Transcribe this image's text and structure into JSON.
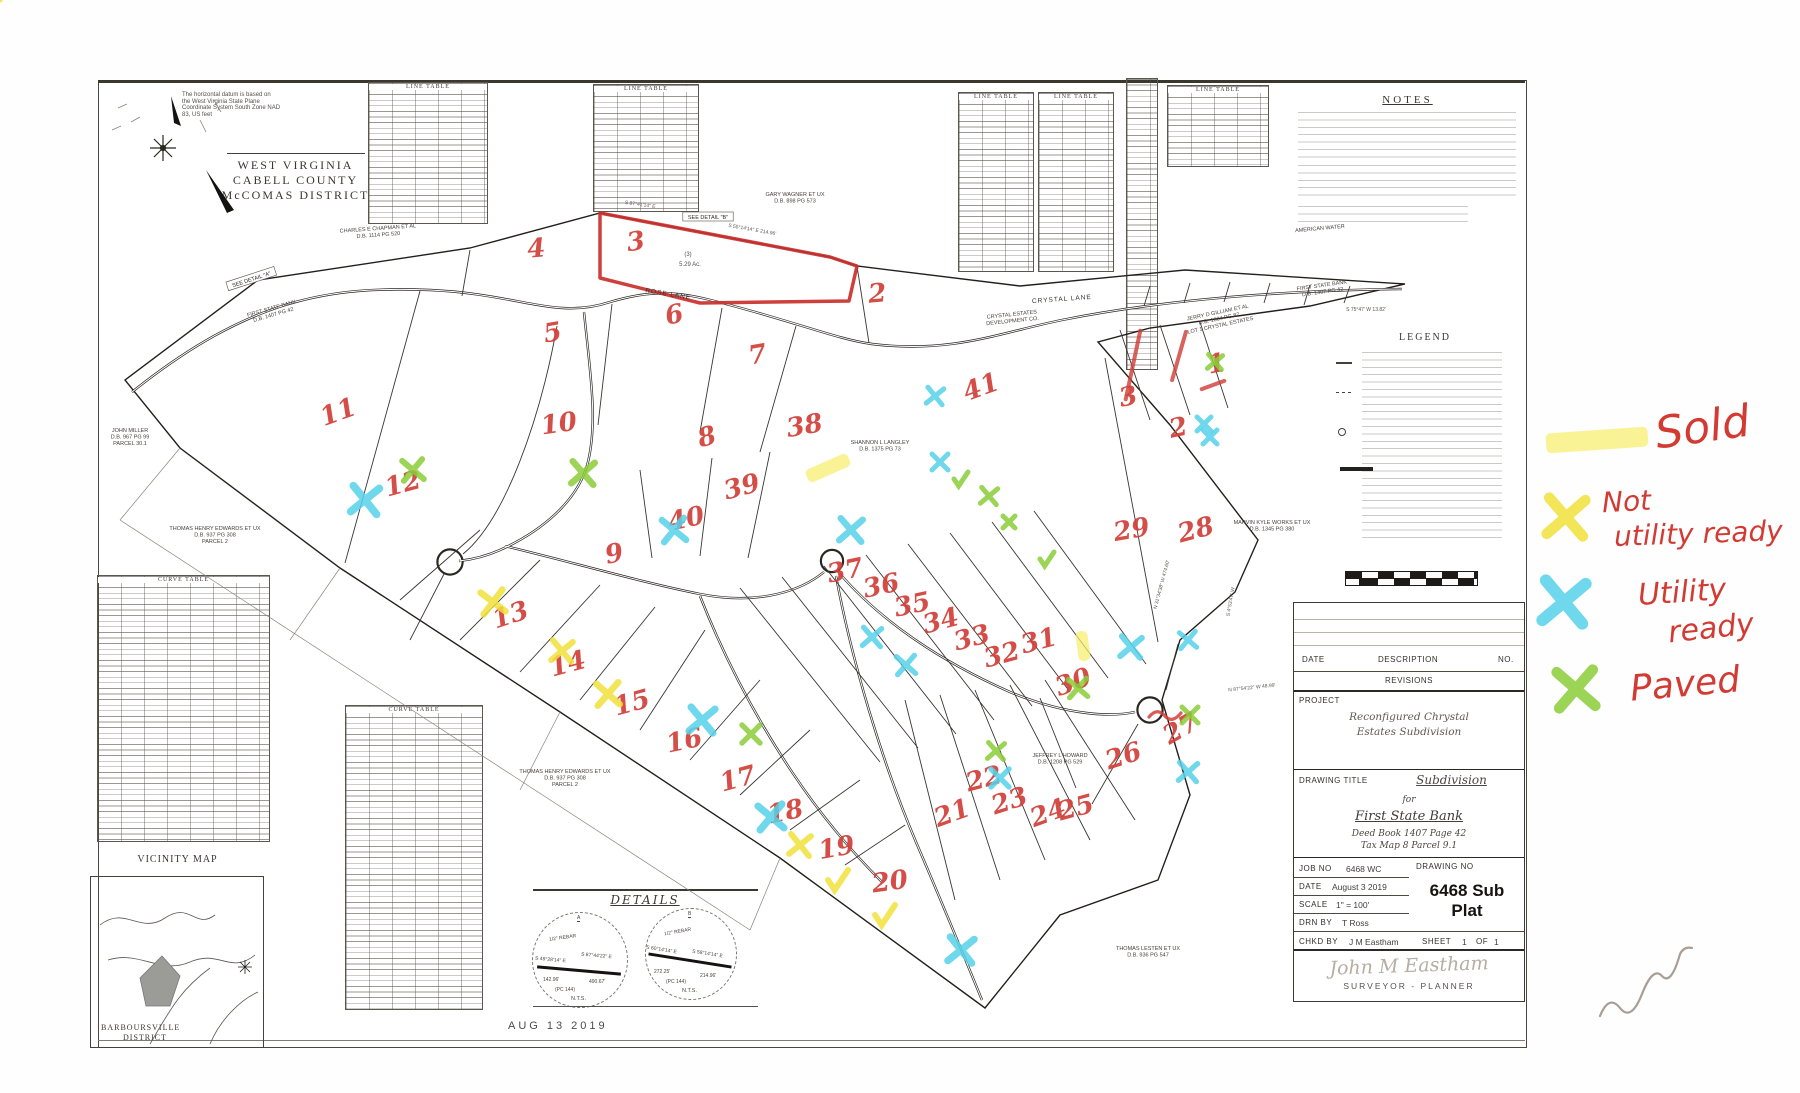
{
  "corner": {
    "datum_lines": [
      "The horizontal datum is based on",
      "the West Virginia State Plane",
      "Coordinate System South Zone NAD",
      "83, US feet"
    ],
    "region": [
      "WEST VIRGINIA",
      "CABELL COUNTY",
      "McCOMAS DISTRICT"
    ]
  },
  "notes": {
    "heading": "NOTES"
  },
  "legend": {
    "heading": "LEGEND"
  },
  "tables": {
    "line_caption": "LINE TABLE",
    "curve_caption": "CURVE TABLE"
  },
  "vicinity": {
    "heading": "VICINITY MAP",
    "district": [
      "BARBOURSVILLE",
      "DISTRICT"
    ]
  },
  "details": {
    "heading": "DETAILS",
    "stamp": "AUG 13 2019",
    "a": {
      "label": "A",
      "rebar": "1/2\" REBAR",
      "line1": "S 49°28'14\" E",
      "dist1": "142.96'",
      "line2": "S 87°44'22\" E",
      "dist2": "490.67'",
      "pc": "(PC 144)",
      "nts": "N.T.S."
    },
    "b": {
      "label": "B",
      "rebar": "1/2\" REBAR",
      "line1": "S 60°14'14\" E",
      "dist1": "272.25'",
      "line2": "S 58°14'14\" E",
      "dist2": "214.96'",
      "pc": "(PC 144)",
      "nts": "N.T.S."
    }
  },
  "titleblock": {
    "date_label": "DATE",
    "description_label": "DESCRIPTION",
    "no_label": "NO.",
    "revisions_label": "REVISIONS",
    "project_label": "PROJECT",
    "project_line1": "Reconfigured Chrystal",
    "project_line2": "Estates Subdivision",
    "drawing_title_label": "DRAWING TITLE",
    "title_line1": "Subdivision",
    "title_line2": "for",
    "title_line3": "First State Bank",
    "title_line4": "Deed Book 1407  Page 42",
    "title_line5": "Tax Map 8  Parcel 9.1",
    "job_no_label": "JOB NO",
    "job_no": "6468 WC",
    "drawing_no_label": "DRAWING NO",
    "drawing_no_big": "6468 Sub Plat",
    "date_row_label": "DATE",
    "date": "August 3  2019",
    "scale_label": "SCALE",
    "scale": "1\" = 100'",
    "drn_label": "DRN  BY",
    "drn": "T  Ross",
    "chkd_label": "CHKD  BY",
    "chkd": "J  M  Eastham",
    "sheet_label": "SHEET",
    "sheet_no": "1",
    "of_label": "OF",
    "of_no": "1",
    "signature": "John M Eastham",
    "role": "SURVEYOR - PLANNER"
  },
  "margin_legend": {
    "sold": "Sold",
    "not1": "Not",
    "not2": "utility ready",
    "util1": "Utility",
    "util2": "ready",
    "paved": "Paved",
    "symbol_colors": {
      "sold_highlight": "#f7ee6e",
      "not_ready_x": "#f2e13c",
      "utility_ready_x": "#57d2e9",
      "paved_x": "#8bcd39",
      "text": "#d23b33"
    }
  },
  "map": {
    "lot_numbers": [
      [
        1,
        1218,
        372,
        -10
      ],
      [
        2,
        878,
        302,
        -5
      ],
      [
        3,
        637,
        250,
        -8
      ],
      [
        4,
        537,
        257,
        -5
      ],
      [
        5,
        554,
        341,
        -10
      ],
      [
        6,
        676,
        323,
        -12
      ],
      [
        7,
        759,
        363,
        -10
      ],
      [
        8,
        709,
        445,
        -15
      ],
      [
        9,
        616,
        562,
        -12
      ],
      [
        10,
        560,
        432,
        -8
      ],
      [
        11,
        341,
        420,
        -20
      ],
      [
        12,
        405,
        492,
        -15
      ],
      [
        13,
        513,
        623,
        -18
      ],
      [
        14,
        570,
        672,
        -15
      ],
      [
        15,
        634,
        711,
        -15
      ],
      [
        16,
        686,
        749,
        -12
      ],
      [
        17,
        740,
        787,
        -15
      ],
      [
        18,
        787,
        820,
        -12
      ],
      [
        19,
        838,
        856,
        -10
      ],
      [
        20,
        891,
        890,
        -8
      ],
      [
        21,
        955,
        821,
        -20
      ],
      [
        22,
        986,
        787,
        -15
      ],
      [
        23,
        1012,
        809,
        -18
      ],
      [
        24,
        1051,
        821,
        -20
      ],
      [
        25,
        1078,
        816,
        -15
      ],
      [
        26,
        1126,
        764,
        -18
      ],
      [
        27,
        1185,
        736,
        -30
      ],
      [
        28,
        1198,
        538,
        -15
      ],
      [
        29,
        1133,
        538,
        -10
      ],
      [
        30,
        1076,
        690,
        -20
      ],
      [
        31,
        1041,
        649,
        -15
      ],
      [
        32,
        1004,
        663,
        -15
      ],
      [
        33,
        974,
        646,
        -15
      ],
      [
        34,
        943,
        629,
        -15
      ],
      [
        35,
        914,
        613,
        -12
      ],
      [
        36,
        883,
        594,
        -12
      ],
      [
        37,
        847,
        579,
        -12
      ],
      [
        38,
        806,
        434,
        -10
      ],
      [
        39,
        744,
        495,
        -15
      ],
      [
        40,
        688,
        527,
        -12
      ],
      [
        41,
        984,
        395,
        -20
      ]
    ],
    "small_numbers": [
      [
        "3",
        1130,
        405
      ],
      [
        "2",
        1180,
        436
      ]
    ],
    "roads": [
      [
        "ROSE LANE",
        668,
        296,
        9
      ],
      [
        "CRYSTAL LANE",
        1062,
        301,
        -4
      ]
    ],
    "detail_refs": [
      [
        "SEE DETAIL \"A\"",
        252,
        281,
        -18
      ],
      [
        "SEE DETAIL \"B\"",
        708,
        219,
        0
      ]
    ],
    "acreage": [
      [
        "(3)",
        688,
        256
      ],
      [
        "5.29 Ac.",
        690,
        266
      ]
    ],
    "bearings": [
      [
        "S 87°41'14\" E",
        640,
        206,
        8
      ],
      [
        "S 55°14'14\" E  214.96'",
        752,
        231,
        10
      ],
      [
        "S 75°47' W  13.82'",
        1366,
        311,
        0
      ],
      [
        "N 31°34'38\" W  474.60'",
        1163,
        585,
        -75
      ],
      [
        "N 87°54'22\" W  48.99'",
        1252,
        689,
        -6
      ],
      [
        "S 4°53'47\" W",
        1232,
        602,
        -80
      ]
    ],
    "owners": [
      [
        378,
        230,
        -4,
        [
          "CHARLES E CHAPMAN ET AL",
          "D.B. 1114 PG 520"
        ]
      ],
      [
        795,
        196,
        0,
        [
          "GARY WAGNER ET UX",
          "D.B. 898 PG 573"
        ]
      ],
      [
        272,
        310,
        -16,
        [
          "FIRST STATE BANK",
          "D.B. 1407 PG 42"
        ]
      ],
      [
        1012,
        316,
        -6,
        [
          "CRYSTAL ESTATES",
          "DEVELOPMENT CO."
        ]
      ],
      [
        1218,
        314,
        -12,
        [
          "JERRY D GILLIAM ET AL",
          "D.B. 1004 PG 87",
          "LOT 1 CRYSTAL ESTATES"
        ]
      ],
      [
        1322,
        287,
        -8,
        [
          "FIRST STATE BANK",
          "D.B. 1407 PG 42"
        ]
      ],
      [
        1320,
        230,
        -5,
        [
          "AMERICAN WATER"
        ]
      ],
      [
        130,
        432,
        0,
        [
          "JOHN MILLER",
          "D.B. 967 PG 99",
          "PARCEL 30.1"
        ]
      ],
      [
        215,
        530,
        0,
        [
          "THOMAS HENRY EDWARDS ET UX",
          "D.B. 937 PG 308",
          "PARCEL 2"
        ]
      ],
      [
        565,
        773,
        0,
        [
          "THOMAS HENRY EDWARDS ET UX",
          "D.B. 937 PG 308",
          "PARCEL 2"
        ]
      ],
      [
        880,
        444,
        0,
        [
          "SHANNON L LANGLEY",
          "D.B. 1375 PG 73"
        ]
      ],
      [
        1272,
        524,
        0,
        [
          "MARVIN KYLE WORKS ET UX",
          "D.B. 1345 PG 380"
        ]
      ],
      [
        1060,
        757,
        0,
        [
          "JEFFREY L HOWARD",
          "D.B. 1208 PG 529"
        ]
      ],
      [
        1148,
        950,
        0,
        [
          "THOMAS LESTEN ET UX",
          "D.B. 936 PG 547"
        ]
      ]
    ],
    "marks": [
      [
        "hl",
        828,
        468,
        46,
        14,
        -24
      ],
      [
        "hl",
        1083,
        646,
        12,
        30,
        -8
      ],
      [
        "hl",
        1597,
        440,
        102,
        20,
        -4
      ],
      [
        "yx",
        493,
        602,
        22,
        -8
      ],
      [
        "yx",
        562,
        651,
        20,
        5
      ],
      [
        "yx",
        608,
        694,
        22,
        -4
      ],
      [
        "yx",
        800,
        845,
        20,
        6
      ],
      [
        "y x",
        0,
        0,
        0,
        0
      ],
      [
        "yx",
        1566,
        517,
        36,
        4
      ],
      [
        "yc",
        838,
        880,
        20,
        0
      ],
      [
        "yc",
        885,
        915,
        20,
        0
      ],
      [
        "cx",
        365,
        500,
        26,
        6
      ],
      [
        "cx",
        674,
        530,
        22,
        -6
      ],
      [
        "cx",
        851,
        530,
        22,
        4
      ],
      [
        "cx",
        940,
        462,
        16,
        0
      ],
      [
        "cx",
        702,
        720,
        24,
        5
      ],
      [
        "cx",
        771,
        817,
        24,
        -5
      ],
      [
        "cx",
        961,
        950,
        24,
        6
      ],
      [
        "cx",
        1000,
        778,
        18,
        0
      ],
      [
        "cx",
        872,
        637,
        18,
        4
      ],
      [
        "cx",
        906,
        665,
        18,
        -4
      ],
      [
        "cx",
        935,
        396,
        16,
        6
      ],
      [
        "cx",
        1204,
        424,
        14,
        0
      ],
      [
        "cx",
        1131,
        647,
        20,
        5
      ],
      [
        "cx",
        1188,
        640,
        16,
        -5
      ],
      [
        "cx",
        1188,
        772,
        18,
        4
      ],
      [
        "cx",
        1210,
        437,
        14,
        0
      ],
      [
        "cx",
        1564,
        602,
        40,
        5
      ],
      [
        "gx",
        413,
        470,
        20,
        -5
      ],
      [
        "gx",
        583,
        473,
        22,
        4
      ],
      [
        "gx",
        751,
        734,
        18,
        0
      ],
      [
        "gx",
        989,
        496,
        16,
        5
      ],
      [
        "gx",
        1009,
        522,
        12,
        0
      ],
      [
        "gx",
        1078,
        688,
        18,
        -4
      ],
      [
        "gx",
        996,
        751,
        16,
        4
      ],
      [
        "gx",
        1190,
        715,
        16,
        0
      ],
      [
        "gx",
        1215,
        362,
        14,
        5
      ],
      [
        "gx",
        1576,
        689,
        36,
        -4
      ],
      [
        "gc",
        961,
        479,
        14,
        0
      ],
      [
        "gc",
        1047,
        559,
        14,
        0
      ],
      [
        "rs",
        1133,
        365,
        70,
        12
      ],
      [
        "rs",
        1179,
        356,
        50,
        16
      ],
      [
        "rs",
        1213,
        385,
        24,
        70
      ],
      [
        "sq",
        1165,
        717,
        0,
        0
      ]
    ]
  }
}
